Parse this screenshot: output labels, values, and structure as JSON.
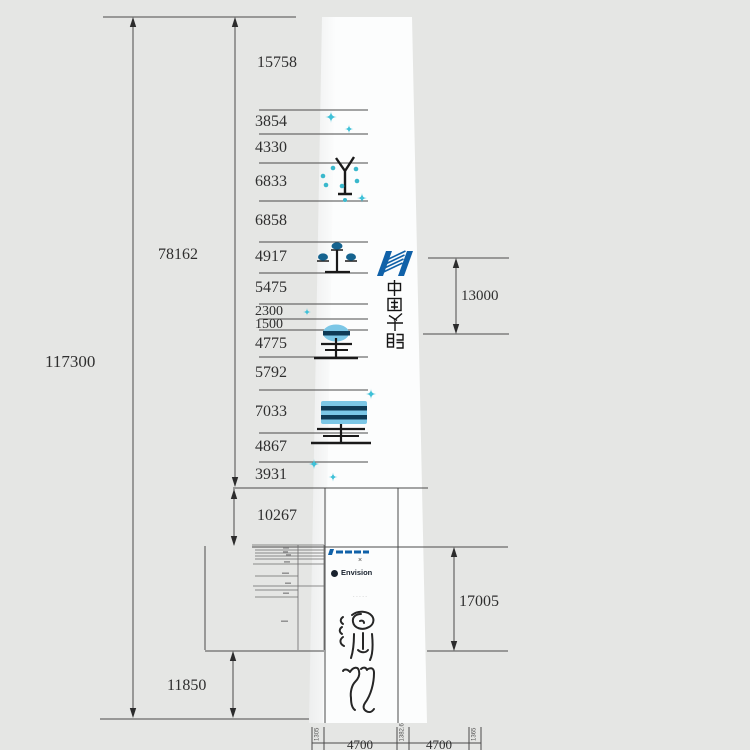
{
  "diagram": {
    "type": "tower elevation drawing",
    "overall_height": "117300",
    "upper_section_height": "78162",
    "base_height": "11850",
    "left_segments": [
      "15758",
      "3854",
      "4330",
      "6833",
      "6858",
      "4917",
      "5475",
      "2300",
      "1500",
      "4775",
      "5792",
      "7033",
      "4867",
      "3931",
      "10267"
    ],
    "right_dimensions": {
      "logo_band": "13000",
      "base_sign": "17005"
    },
    "bottom_widths": [
      "4700",
      "4700"
    ],
    "bottom_side_labels": [
      "1305",
      "1382.6",
      "1365"
    ]
  },
  "branding": {
    "huaneng_vertical_text": "中国华能",
    "sign_top_text": "中国华能",
    "sign_times": "×",
    "sign_partner_row": "Envision",
    "sign_fine_print": "· · · · ·",
    "seal_artwork_text": "演化"
  },
  "colors": {
    "background": "#e5e6e4",
    "line": "#4a4a4a",
    "huaneng_blue": "#1061a8",
    "cyan_sparkle": "#3fc1d8",
    "light_blue": "#7cc7e6",
    "navy": "#0e3a55",
    "dark_teal_blue": "#15638f"
  }
}
